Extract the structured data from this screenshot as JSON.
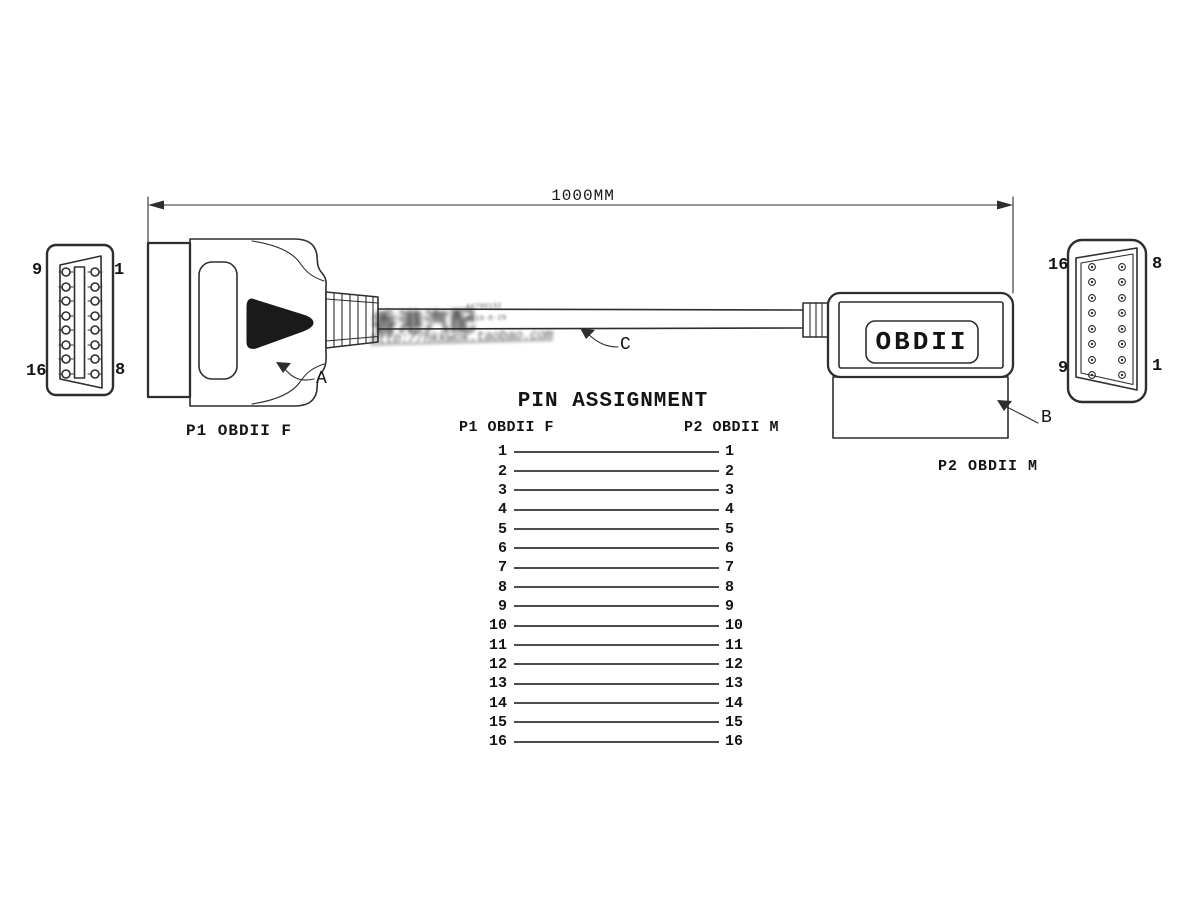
{
  "colors": {
    "line": "#2e2e2e",
    "table_line": "#4d4d4d",
    "text": "#141414",
    "background": "#ffffff",
    "wedge": "#1a1a1a"
  },
  "dimension": {
    "label": "1000MM"
  },
  "left_face": {
    "pins": {
      "top_left": "9",
      "top_right": "1",
      "bottom_left": "16",
      "bottom_right": "8"
    }
  },
  "right_face": {
    "pins": {
      "top_left": "16",
      "top_right": "8",
      "bottom_left": "9",
      "bottom_right": "1"
    }
  },
  "connectors": {
    "p1_label": "P1 OBDII F",
    "p2_label": "P2 OBDII M",
    "plate_text": "OBDII"
  },
  "callouts": {
    "a": "A",
    "b": "B",
    "c": "C"
  },
  "watermark": {
    "cn": "香港汽配",
    "url": "http://hkkwok.taobao.com",
    "small_top": "44796132",
    "small_bottom": "4119-8-29"
  },
  "pin_assignment": {
    "title": "PIN ASSIGNMENT",
    "left_header": "P1 OBDII F",
    "right_header": "P2 OBDII M",
    "rows": [
      {
        "p1": "1",
        "p2": "1"
      },
      {
        "p1": "2",
        "p2": "2"
      },
      {
        "p1": "3",
        "p2": "3"
      },
      {
        "p1": "4",
        "p2": "4"
      },
      {
        "p1": "5",
        "p2": "5"
      },
      {
        "p1": "6",
        "p2": "6"
      },
      {
        "p1": "7",
        "p2": "7"
      },
      {
        "p1": "8",
        "p2": "8"
      },
      {
        "p1": "9",
        "p2": "9"
      },
      {
        "p1": "10",
        "p2": "10"
      },
      {
        "p1": "11",
        "p2": "11"
      },
      {
        "p1": "12",
        "p2": "12"
      },
      {
        "p1": "13",
        "p2": "13"
      },
      {
        "p1": "14",
        "p2": "14"
      },
      {
        "p1": "15",
        "p2": "15"
      },
      {
        "p1": "16",
        "p2": "16"
      }
    ]
  }
}
